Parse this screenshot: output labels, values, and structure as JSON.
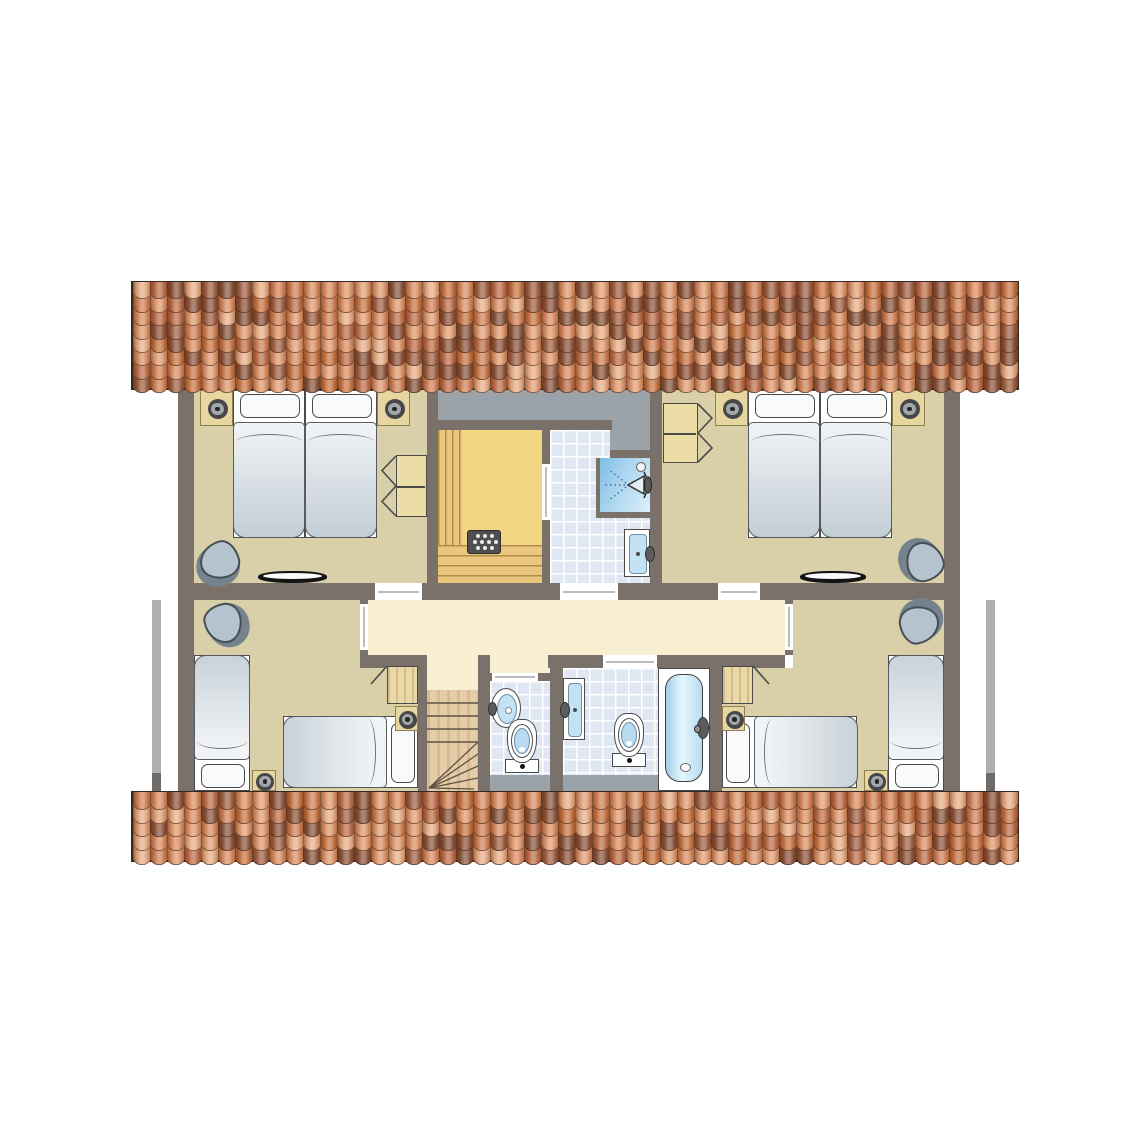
{
  "title": "cottage-upper-floor-plan",
  "colors": {
    "wall": "#7a716b",
    "floor_bedroom": "#d9cfa8",
    "floor_hall": "#f8eed1",
    "floor_sauna": "#f3d684",
    "sauna_bench": "#eac77d",
    "floor_tile": "#dfe7f2",
    "roof_void": "#9aa2aa",
    "fixture_outline": "#4b4b4b",
    "water_blue": "#b7dcf2",
    "mattress_light": "#f1f4f6",
    "mattress_dark": "#c3cdd5",
    "stairs_wood": "#e5cda8",
    "roof_base": "#7a4f38",
    "roof_edge": "#352820",
    "eave": "#b2aeab"
  },
  "rooms": [
    {
      "name": "bedroom-top-left"
    },
    {
      "name": "bedroom-top-right"
    },
    {
      "name": "bedroom-bottom-left"
    },
    {
      "name": "bedroom-bottom-right"
    },
    {
      "name": "sauna"
    },
    {
      "name": "shower-room"
    },
    {
      "name": "wc"
    },
    {
      "name": "bathroom"
    },
    {
      "name": "hallway"
    },
    {
      "name": "staircase"
    }
  ],
  "roof": {
    "cols": 52,
    "palette": [
      "#e09a70",
      "#cf7e53",
      "#ba6a45",
      "#9b5c3f",
      "#845138",
      "#e7ab83",
      "#c4713f",
      "#d88a5e",
      "#8a4f36",
      "#dd9468"
    ],
    "strips": [
      {
        "name": "roof-strip-top",
        "r": [
          131,
          281,
          888,
          109
        ],
        "rows": 8
      },
      {
        "name": "roof-strip-bottom",
        "r": [
          131,
          791,
          888,
          71
        ],
        "rows": 5
      }
    ]
  },
  "plan": {
    "eaves": [
      {
        "name": "eave-line-left",
        "r": [
          152,
          600,
          9,
          191
        ]
      },
      {
        "name": "eave-line-right",
        "r": [
          986,
          600,
          9,
          191
        ]
      }
    ],
    "floors": [
      {
        "name": "bedroom-top-left-floor",
        "class": "f-tan",
        "r": [
          194,
          390,
          233,
          193
        ]
      },
      {
        "name": "bedroom-top-right-floor",
        "class": "f-tan",
        "r": [
          662,
          390,
          282,
          193
        ]
      },
      {
        "name": "sauna-floor",
        "class": "f-sauna",
        "r": [
          438,
          430,
          104,
          153
        ]
      },
      {
        "name": "shower-room-floor",
        "class": "f-tile",
        "r": [
          550,
          430,
          100,
          153
        ]
      },
      {
        "name": "hallway-floor",
        "class": "f-cream",
        "r": [
          368,
          600,
          417,
          55
        ]
      },
      {
        "name": "hallway-ext-stairs",
        "class": "f-cream",
        "r": [
          427,
          655,
          51,
          35
        ]
      },
      {
        "name": "hallway-ext-wc",
        "class": "f-cream",
        "r": [
          490,
          655,
          60,
          18
        ]
      },
      {
        "name": "bedroom-bottom-left-floor-a",
        "class": "f-tan",
        "r": [
          194,
          600,
          166,
          68
        ]
      },
      {
        "name": "bedroom-bottom-left-floor-b",
        "class": "f-tan",
        "r": [
          194,
          668,
          224,
          123
        ]
      },
      {
        "name": "bedroom-bottom-right-floor-a",
        "class": "f-tan",
        "r": [
          793,
          600,
          151,
          68
        ]
      },
      {
        "name": "bedroom-bottom-right-floor-b",
        "class": "f-tan",
        "r": [
          722,
          668,
          222,
          123
        ]
      },
      {
        "name": "wc-floor",
        "class": "f-tile",
        "r": [
          490,
          681,
          60,
          94
        ]
      },
      {
        "name": "bathroom-floor",
        "class": "f-tile",
        "r": [
          563,
          668,
          97,
          107
        ]
      },
      {
        "name": "bathtub-enclosure",
        "class": "f-white",
        "r": [
          658,
          668,
          52,
          123
        ]
      }
    ],
    "voids": [
      {
        "name": "roof-void-top",
        "r": [
          438,
          390,
          212,
          30
        ]
      },
      {
        "name": "roof-void-arm",
        "r": [
          610,
          420,
          40,
          30
        ]
      },
      {
        "name": "roof-void-bottom-left",
        "r": [
          490,
          775,
          60,
          16
        ]
      },
      {
        "name": "roof-void-bottom-right",
        "r": [
          563,
          775,
          95,
          16
        ]
      }
    ],
    "walls": [
      {
        "r": [
          178,
          390,
          16,
          401
        ]
      },
      {
        "r": [
          944,
          390,
          16,
          401
        ]
      },
      {
        "r": [
          178,
          583,
          782,
          17
        ]
      },
      {
        "r": [
          427,
          390,
          11,
          193
        ]
      },
      {
        "r": [
          542,
          430,
          8,
          153
        ]
      },
      {
        "r": [
          438,
          420,
          174,
          10
        ]
      },
      {
        "r": [
          610,
          450,
          40,
          8
        ]
      },
      {
        "r": [
          596,
          458,
          4,
          54
        ]
      },
      {
        "r": [
          596,
          512,
          54,
          6
        ]
      },
      {
        "r": [
          650,
          390,
          12,
          193
        ]
      },
      {
        "r": [
          360,
          600,
          8,
          55
        ]
      },
      {
        "r": [
          785,
          600,
          8,
          55
        ]
      },
      {
        "r": [
          360,
          655,
          67,
          13
        ]
      },
      {
        "r": [
          548,
          655,
          237,
          13
        ]
      },
      {
        "r": [
          418,
          668,
          9,
          123
        ]
      },
      {
        "r": [
          478,
          655,
          12,
          136
        ]
      },
      {
        "r": [
          490,
          673,
          60,
          8
        ]
      },
      {
        "r": [
          550,
          668,
          13,
          123
        ]
      },
      {
        "r": [
          710,
          668,
          12,
          123
        ]
      }
    ],
    "openings": [
      {
        "name": "door-bedroom-top-left",
        "r": [
          375,
          583,
          47,
          17
        ],
        "dir": "h"
      },
      {
        "name": "door-shower-room",
        "r": [
          560,
          583,
          58,
          17
        ],
        "dir": "h"
      },
      {
        "name": "door-bedroom-top-right",
        "r": [
          718,
          583,
          42,
          17
        ],
        "dir": "h"
      },
      {
        "name": "door-bedroom-bottom-left",
        "r": [
          360,
          604,
          8,
          46
        ],
        "dir": "v"
      },
      {
        "name": "door-bedroom-bottom-right",
        "r": [
          785,
          604,
          8,
          46
        ],
        "dir": "v"
      },
      {
        "name": "door-bathroom",
        "r": [
          603,
          655,
          54,
          13
        ],
        "dir": "h"
      },
      {
        "name": "door-wc",
        "r": [
          492,
          673,
          46,
          8
        ],
        "dir": "h"
      },
      {
        "name": "door-sauna",
        "r": [
          542,
          464,
          8,
          56
        ],
        "dir": "v"
      }
    ],
    "fixtures": [
      {
        "type": "nightstand",
        "name": "nightstand-spot",
        "r": [
          200,
          390,
          33,
          36
        ]
      },
      {
        "type": "nightstand",
        "name": "nightstand-spot",
        "r": [
          377,
          390,
          33,
          36
        ]
      },
      {
        "type": "bed",
        "name": "bed-single",
        "r": [
          233,
          390,
          72,
          148
        ],
        "pillow": "top"
      },
      {
        "type": "bed",
        "name": "bed-single",
        "r": [
          305,
          390,
          72,
          148
        ],
        "pillow": "top"
      },
      {
        "type": "wardrobe",
        "name": "wardrobe",
        "r": [
          396,
          455,
          31,
          62
        ],
        "open": "left"
      },
      {
        "type": "chair",
        "name": "chair",
        "r": [
          198,
          541,
          44,
          42
        ],
        "rot": -15
      },
      {
        "type": "roofwindow",
        "name": "roof-window",
        "r": [
          258,
          571,
          69,
          12
        ]
      },
      {
        "type": "wardrobe",
        "name": "wardrobe",
        "r": [
          663,
          403,
          35,
          60
        ],
        "open": "right"
      },
      {
        "type": "nightstand",
        "name": "nightstand-spot",
        "r": [
          715,
          390,
          33,
          36
        ]
      },
      {
        "type": "nightstand",
        "name": "nightstand-spot",
        "r": [
          892,
          390,
          33,
          36
        ]
      },
      {
        "type": "bed",
        "name": "bed-single",
        "r": [
          748,
          390,
          72,
          148
        ],
        "pillow": "top"
      },
      {
        "type": "bed",
        "name": "bed-single",
        "r": [
          820,
          390,
          72,
          148
        ],
        "pillow": "top"
      },
      {
        "type": "chair",
        "name": "chair",
        "r": [
          901,
          541,
          44,
          42
        ],
        "rot": 75
      },
      {
        "type": "roofwindow",
        "name": "roof-window",
        "r": [
          800,
          571,
          66,
          12
        ]
      },
      {
        "type": "bench",
        "name": "sauna-bench",
        "r": [
          438,
          430,
          24,
          115
        ],
        "dir": "v"
      },
      {
        "type": "bench",
        "name": "sauna-bench",
        "r": [
          438,
          545,
          104,
          38
        ],
        "dir": "h"
      },
      {
        "type": "heater",
        "name": "sauna-heater",
        "r": [
          467,
          530,
          34,
          24
        ]
      },
      {
        "type": "shower",
        "name": "shower",
        "r": [
          600,
          458,
          50,
          54
        ]
      },
      {
        "type": "basin",
        "name": "washbasin",
        "r": [
          624,
          529,
          26,
          48
        ],
        "tap": "right"
      },
      {
        "type": "basinoval",
        "name": "corner-washbasin",
        "r": [
          491,
          688,
          30,
          40
        ],
        "tap": "left"
      },
      {
        "type": "toilet",
        "name": "toilet",
        "r": [
          504,
          719,
          36,
          54
        ]
      },
      {
        "type": "basin",
        "name": "washbasin",
        "r": [
          563,
          678,
          22,
          62
        ],
        "tap": "left"
      },
      {
        "type": "toilet",
        "name": "toilet",
        "r": [
          611,
          713,
          36,
          54
        ]
      },
      {
        "type": "bathtub",
        "name": "bathtub",
        "r": [
          665,
          674,
          38,
          108
        ]
      },
      {
        "type": "chair",
        "name": "chair",
        "r": [
          203,
          602,
          44,
          42
        ],
        "rot": -100
      },
      {
        "type": "bed",
        "name": "bed-single",
        "r": [
          194,
          655,
          56,
          136
        ],
        "pillow": "bottom"
      },
      {
        "type": "bed",
        "name": "bed-single",
        "r": [
          283,
          716,
          135,
          72
        ],
        "pillow": "right"
      },
      {
        "type": "wardrobe2",
        "name": "wardrobe",
        "r": [
          387,
          666,
          31,
          38
        ],
        "open": "left"
      },
      {
        "type": "spotbox",
        "name": "ceiling-spot",
        "r": [
          395,
          706,
          23,
          25
        ]
      },
      {
        "type": "spotbox",
        "name": "ceiling-spot",
        "r": [
          252,
          770,
          24,
          21
        ]
      },
      {
        "type": "chair",
        "name": "chair",
        "r": [
          897,
          602,
          44,
          42
        ],
        "rot": 170
      },
      {
        "type": "bed",
        "name": "bed-single",
        "r": [
          888,
          655,
          56,
          136
        ],
        "pillow": "bottom"
      },
      {
        "type": "bed",
        "name": "bed-single",
        "r": [
          722,
          716,
          135,
          72
        ],
        "pillow": "left"
      },
      {
        "type": "wardrobe2",
        "name": "wardrobe",
        "r": [
          722,
          666,
          31,
          38
        ],
        "open": "right"
      },
      {
        "type": "spotbox",
        "name": "ceiling-spot",
        "r": [
          722,
          706,
          23,
          25
        ]
      },
      {
        "type": "spotbox",
        "name": "ceiling-spot",
        "r": [
          864,
          770,
          24,
          21
        ]
      },
      {
        "type": "stairs",
        "name": "staircase",
        "r": [
          427,
          690,
          51,
          101
        ]
      }
    ]
  }
}
